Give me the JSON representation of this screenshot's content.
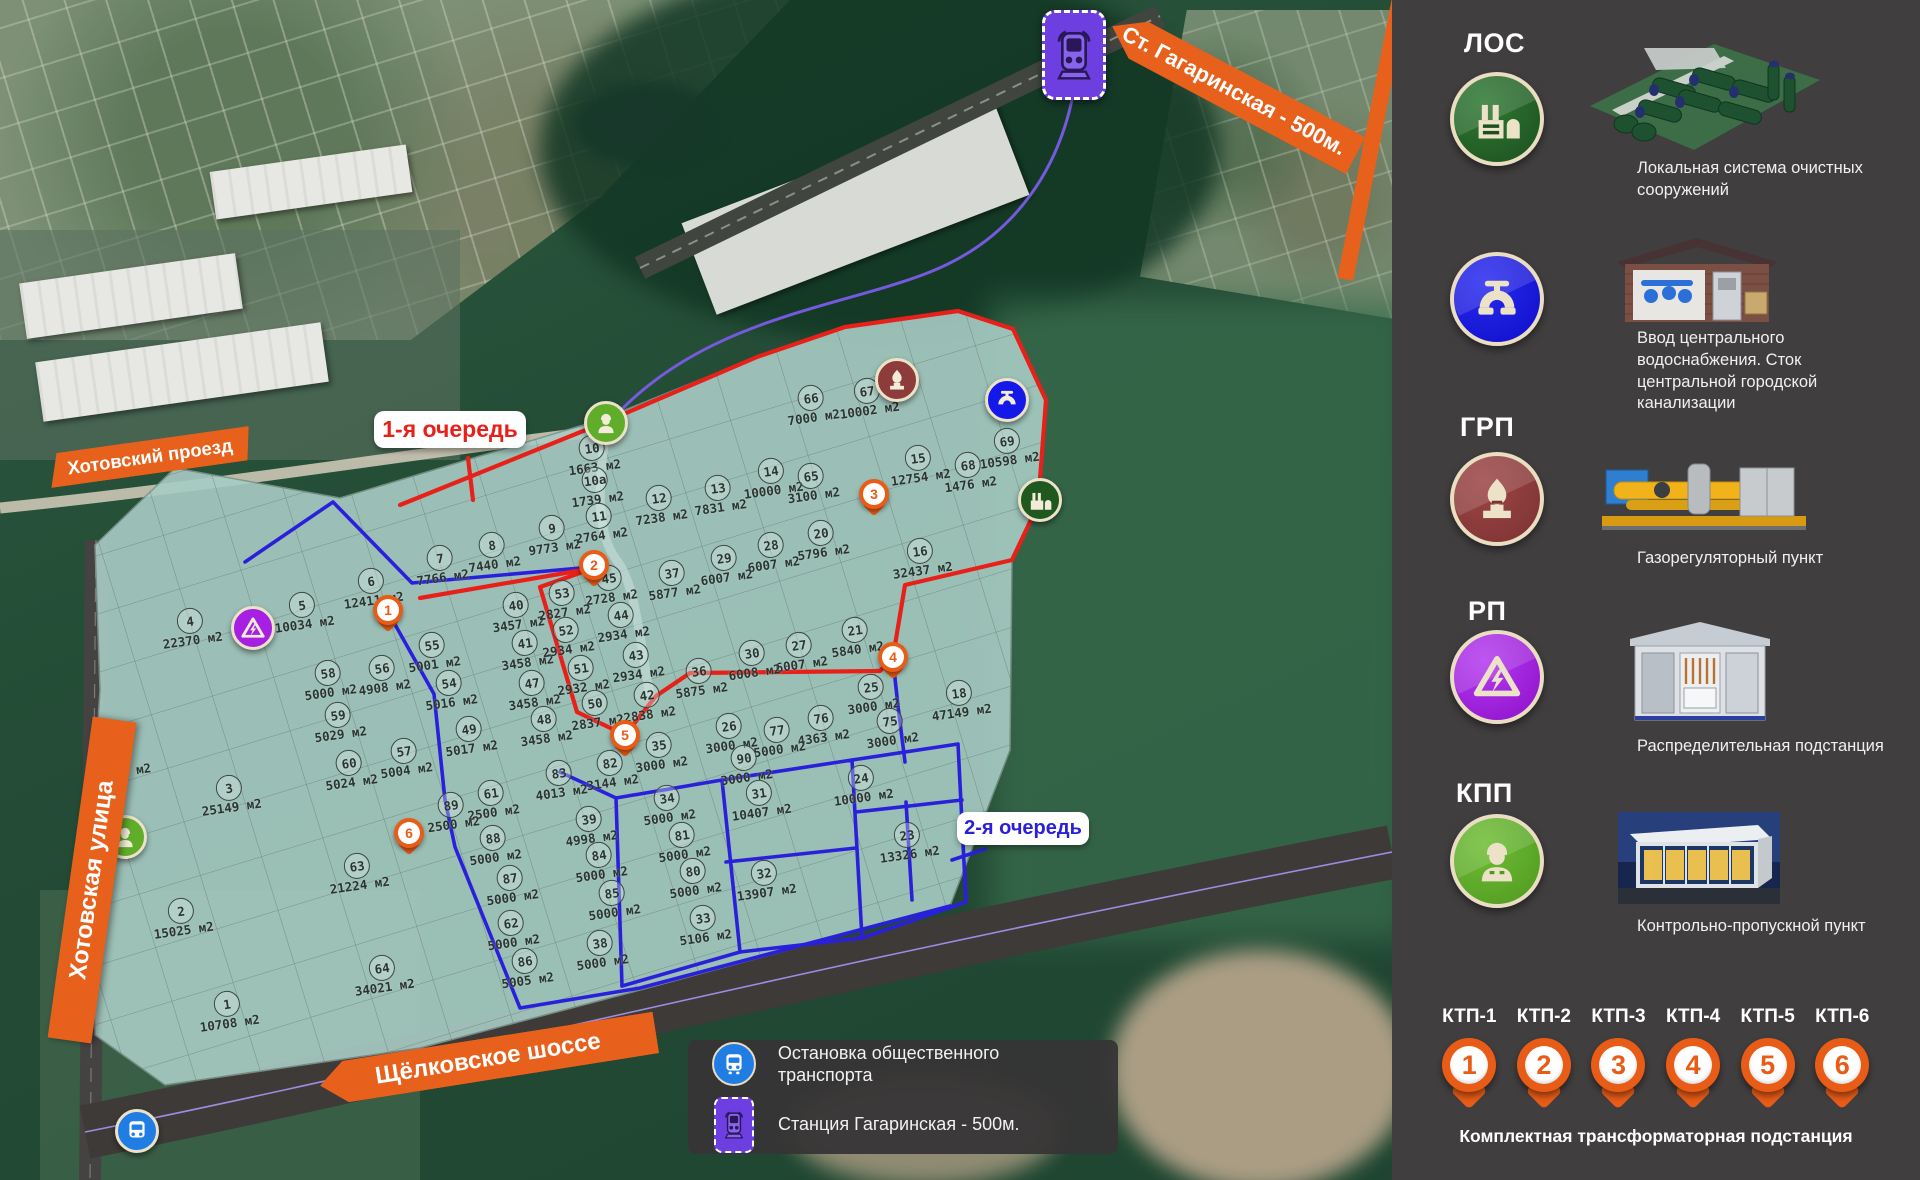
{
  "map": {
    "phase1_label": "1-я очередь",
    "phase2_label": "2-я очередь",
    "street_top": "Хотовский проезд",
    "street_left": "Хотовская улица",
    "street_bottom": "Щёлковское шоссе",
    "station_banner": "Ст. Гагаринская - 500м.",
    "plots": [
      {
        "n": "1",
        "a": "10708 м2",
        "x": 228,
        "y": 1011
      },
      {
        "n": "2",
        "a": "15025 м2",
        "x": 182,
        "y": 918
      },
      {
        "n": "3",
        "a": "25149 м2",
        "x": 230,
        "y": 795
      },
      {
        "n": "4",
        "a": "22370 м2",
        "x": 191,
        "y": 628
      },
      {
        "n": "5",
        "a": "10034 м2",
        "x": 303,
        "y": 612
      },
      {
        "n": "6",
        "a": "12411 м2",
        "x": 372,
        "y": 588
      },
      {
        "n": "7",
        "a": "7766 м2",
        "x": 441,
        "y": 565
      },
      {
        "n": "8",
        "a": "7440 м2",
        "x": 493,
        "y": 552
      },
      {
        "n": "9",
        "a": "9773 м2",
        "x": 553,
        "y": 535
      },
      {
        "n": "10",
        "a": "1663 м2",
        "x": 593,
        "y": 455
      },
      {
        "n": "10а",
        "a": "1739 м2",
        "x": 596,
        "y": 487
      },
      {
        "n": "11",
        "a": "2764 м2",
        "x": 600,
        "y": 523
      },
      {
        "n": "12",
        "a": "7238 м2",
        "x": 660,
        "y": 505
      },
      {
        "n": "13",
        "a": "7831 м2",
        "x": 719,
        "y": 495
      },
      {
        "n": "14",
        "a": "10000 м2",
        "x": 772,
        "y": 478
      },
      {
        "n": "15",
        "a": "12754 м2",
        "x": 919,
        "y": 465
      },
      {
        "n": "16",
        "a": "32437 м2",
        "x": 921,
        "y": 558
      },
      {
        "n": "18",
        "a": "47149 м2",
        "x": 960,
        "y": 700
      },
      {
        "n": "20",
        "a": "5796 м2",
        "x": 822,
        "y": 540
      },
      {
        "n": "21",
        "a": "5840 м2",
        "x": 856,
        "y": 637
      },
      {
        "n": "23",
        "a": "13326 м2",
        "x": 908,
        "y": 842
      },
      {
        "n": "24",
        "a": "10000 м2",
        "x": 862,
        "y": 785
      },
      {
        "n": "25",
        "a": "3000 м2",
        "x": 872,
        "y": 694
      },
      {
        "n": "26",
        "a": "3000 м2",
        "x": 730,
        "y": 733
      },
      {
        "n": "27",
        "a": "6007 м2",
        "x": 800,
        "y": 652
      },
      {
        "n": "28",
        "a": "6007 м2",
        "x": 772,
        "y": 552
      },
      {
        "n": "29",
        "a": "6007 м2",
        "x": 725,
        "y": 565
      },
      {
        "n": "30",
        "a": "6008 м2",
        "x": 753,
        "y": 660
      },
      {
        "n": "31",
        "a": "10407 м2",
        "x": 760,
        "y": 800
      },
      {
        "n": "32",
        "a": "13907 м2",
        "x": 765,
        "y": 880
      },
      {
        "n": "33",
        "a": "5106 м2",
        "x": 704,
        "y": 925
      },
      {
        "n": "34",
        "a": "5000 м2",
        "x": 668,
        "y": 805
      },
      {
        "n": "35",
        "a": "3000 м2",
        "x": 660,
        "y": 752
      },
      {
        "n": "36",
        "a": "5875 м2",
        "x": 700,
        "y": 678
      },
      {
        "n": "37",
        "a": "5877 м2",
        "x": 673,
        "y": 580
      },
      {
        "n": "38",
        "a": "5000 м2",
        "x": 601,
        "y": 950
      },
      {
        "n": "39",
        "a": "4998 м2",
        "x": 590,
        "y": 826
      },
      {
        "n": "40",
        "a": "3457 м2",
        "x": 517,
        "y": 612
      },
      {
        "n": "41",
        "a": "3458 м2",
        "x": 526,
        "y": 650
      },
      {
        "n": "42",
        "a": "2838 м2",
        "x": 648,
        "y": 702
      },
      {
        "n": "43",
        "a": "2934 м2",
        "x": 637,
        "y": 662
      },
      {
        "n": "44",
        "a": "2934 м2",
        "x": 622,
        "y": 622
      },
      {
        "n": "45",
        "a": "2728 м2",
        "x": 610,
        "y": 585
      },
      {
        "n": "47",
        "a": "3458 м2",
        "x": 533,
        "y": 690
      },
      {
        "n": "48",
        "a": "3458 м2",
        "x": 545,
        "y": 726
      },
      {
        "n": "49",
        "a": "5017 м2",
        "x": 470,
        "y": 736
      },
      {
        "n": "50",
        "a": "2837 м2",
        "x": 596,
        "y": 710
      },
      {
        "n": "51",
        "a": "2932 м2",
        "x": 582,
        "y": 675
      },
      {
        "n": "52",
        "a": "2934 м2",
        "x": 567,
        "y": 637
      },
      {
        "n": "53",
        "a": "2827 м2",
        "x": 563,
        "y": 600
      },
      {
        "n": "54",
        "a": "5016 м2",
        "x": 450,
        "y": 690
      },
      {
        "n": "55",
        "a": "5001 м2",
        "x": 433,
        "y": 652
      },
      {
        "n": "56",
        "a": "4908 м2",
        "x": 383,
        "y": 675
      },
      {
        "n": "57",
        "a": "5004 м2",
        "x": 405,
        "y": 758
      },
      {
        "n": "58",
        "a": "5000 м2",
        "x": 329,
        "y": 680
      },
      {
        "n": "59",
        "a": "5029 м2",
        "x": 339,
        "y": 722
      },
      {
        "n": "60",
        "a": "5024 м2",
        "x": 350,
        "y": 770
      },
      {
        "n": "61",
        "a": "2500 м2",
        "x": 492,
        "y": 800
      },
      {
        "n": "62",
        "a": "5000 м2",
        "x": 512,
        "y": 930
      },
      {
        "n": "63",
        "a": "21224 м2",
        "x": 358,
        "y": 873
      },
      {
        "n": "64",
        "a": "34021 м2",
        "x": 383,
        "y": 975
      },
      {
        "n": "65",
        "a": "3100 м2",
        "x": 812,
        "y": 483
      },
      {
        "n": "66",
        "a": "7000 м2",
        "x": 812,
        "y": 405
      },
      {
        "n": "67",
        "a": "10002 м2",
        "x": 868,
        "y": 398
      },
      {
        "n": "68",
        "a": "1476 м2",
        "x": 969,
        "y": 472
      },
      {
        "n": "69",
        "a": "10598 м2",
        "x": 1008,
        "y": 448
      },
      {
        "n": "75",
        "a": "3000 м2",
        "x": 891,
        "y": 728
      },
      {
        "n": "76",
        "a": "4363 м2",
        "x": 822,
        "y": 725
      },
      {
        "n": "77",
        "a": "5000 м2",
        "x": 778,
        "y": 737
      },
      {
        "n": "80",
        "a": "5000 м2",
        "x": 694,
        "y": 878
      },
      {
        "n": "81",
        "a": "5000 м2",
        "x": 683,
        "y": 842
      },
      {
        "n": "82",
        "a": "3144 м2",
        "x": 611,
        "y": 770
      },
      {
        "n": "83",
        "a": "4013 м2",
        "x": 560,
        "y": 780
      },
      {
        "n": "84",
        "a": "5000 м2",
        "x": 600,
        "y": 862
      },
      {
        "n": "85",
        "a": "5000 м2",
        "x": 613,
        "y": 900
      },
      {
        "n": "86",
        "a": "5005 м2",
        "x": 526,
        "y": 968
      },
      {
        "n": "87",
        "a": "5000 м2",
        "x": 511,
        "y": 885
      },
      {
        "n": "88",
        "a": "5000 м2",
        "x": 494,
        "y": 845
      },
      {
        "n": "89",
        "a": "2500 м2",
        "x": 452,
        "y": 812
      },
      {
        "n": "90",
        "a": "3000 м2",
        "x": 745,
        "y": 765
      },
      {
        "n": "",
        "a": "5000 м2",
        "x": 125,
        "y": 772
      }
    ],
    "pins": [
      {
        "n": "1",
        "x": 388,
        "y": 610
      },
      {
        "n": "2",
        "x": 594,
        "y": 565
      },
      {
        "n": "3",
        "x": 874,
        "y": 494
      },
      {
        "n": "4",
        "x": 893,
        "y": 657
      },
      {
        "n": "5",
        "x": 625,
        "y": 735
      },
      {
        "n": "6",
        "x": 409,
        "y": 833
      }
    ],
    "utility_icons": [
      {
        "t": "kpp",
        "x": 606,
        "y": 423
      },
      {
        "t": "kpp",
        "x": 125,
        "y": 837
      },
      {
        "t": "rp",
        "x": 253,
        "y": 628
      },
      {
        "t": "grp",
        "x": 897,
        "y": 380
      },
      {
        "t": "water",
        "x": 1007,
        "y": 400
      },
      {
        "t": "los",
        "x": 1040,
        "y": 500
      },
      {
        "t": "bus",
        "x": 137,
        "y": 1131
      }
    ]
  },
  "legend_box": {
    "items": [
      {
        "icon": "bus",
        "label": "Остановка общественного транспорта"
      },
      {
        "icon": "train",
        "label": "Станция  Гагаринская - 500м."
      }
    ]
  },
  "sidebar": {
    "sections": [
      {
        "abbr": "ЛОС",
        "caption": "Локальная система очистных сооружений"
      },
      {
        "abbr": "",
        "caption": "Ввод центрального водоснабжения. Сток центральной городской канализации"
      },
      {
        "abbr": "ГРП",
        "caption": "Газорегуляторный пункт"
      },
      {
        "abbr": "РП",
        "caption": "Распределительная подстанция"
      },
      {
        "abbr": "КПП",
        "caption": "Контрольно-пропускной пункт"
      }
    ],
    "ktp": {
      "labels": [
        "КТП-1",
        "КТП-2",
        "КТП-3",
        "КТП-4",
        "КТП-5",
        "КТП-6"
      ],
      "numbers": [
        "1",
        "2",
        "3",
        "4",
        "5",
        "6"
      ],
      "caption": "Комплектная трансформаторная подстанция"
    }
  },
  "colors": {
    "accent_orange": "#E8611C",
    "phase1_red": "#E8201A",
    "phase2_blue": "#2A20DC",
    "site_overlay": "#A8CCC4",
    "sidebar_bg": "#413E3F"
  }
}
